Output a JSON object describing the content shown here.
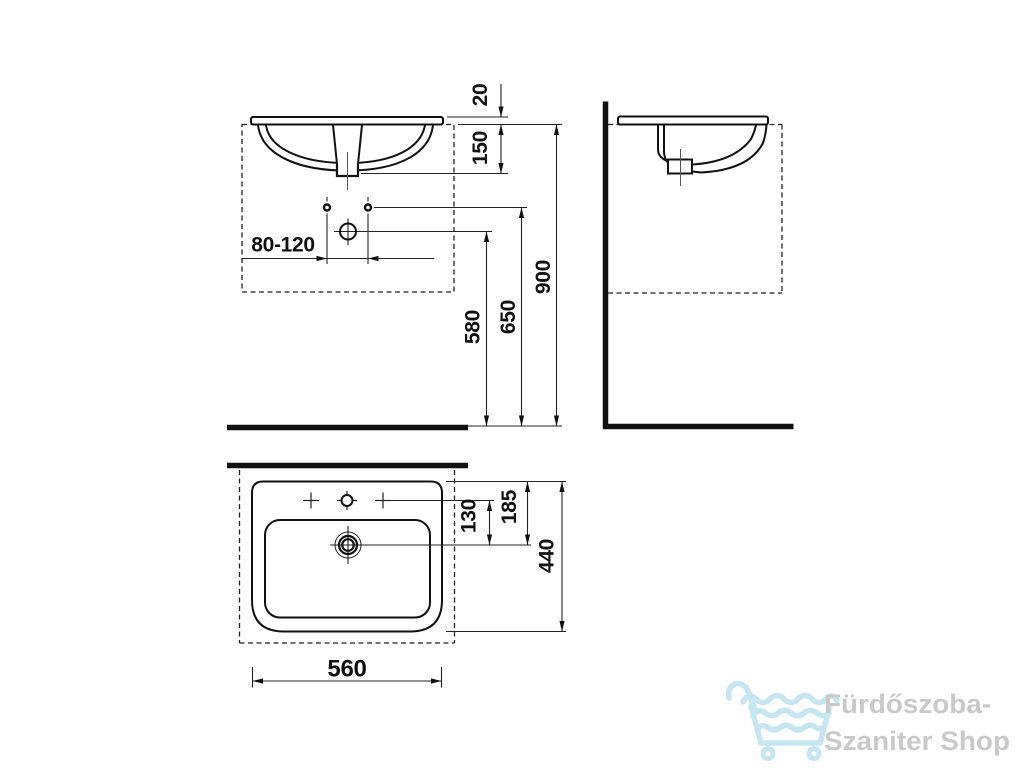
{
  "drawing": {
    "product": "washbasin-technical-drawing",
    "dimensions": {
      "front": {
        "rim_thickness": "20",
        "rim_to_outlet": "150",
        "tap_hole_spacing": "80-120",
        "drain_height": "580",
        "tap_height": "650",
        "rim_height": "900"
      },
      "top": {
        "taps_to_drain": "130",
        "edge_to_drain": "185",
        "depth": "440",
        "width": "560"
      }
    },
    "line_color": "#111111",
    "background": "#ffffff"
  },
  "watermark": {
    "line1": "Fürdőszoba-",
    "line2": "Szaniter Shop",
    "icon": "shopping-cart-waves-icon",
    "icon_color": "#c5e6f0",
    "text_color": "#c9c9c9"
  }
}
